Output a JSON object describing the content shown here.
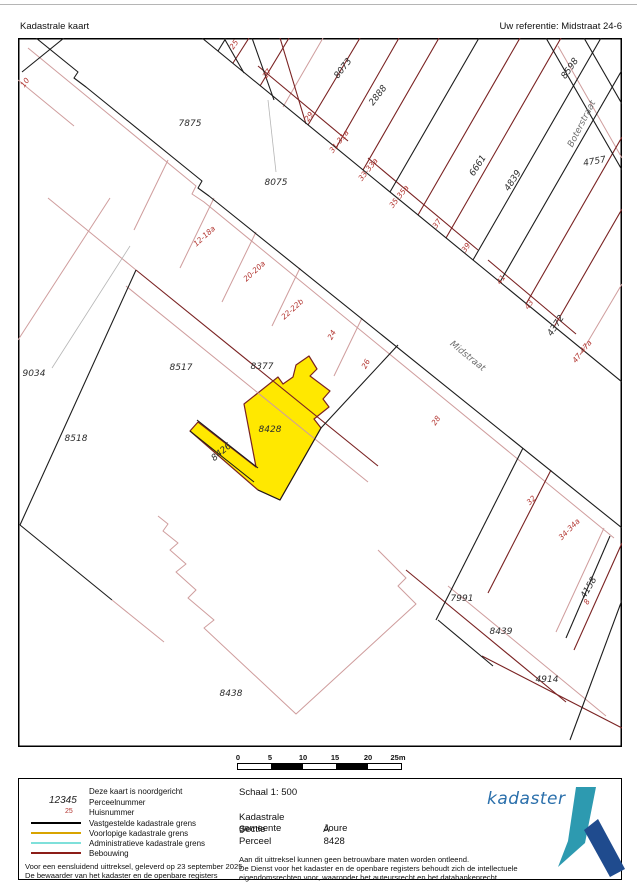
{
  "header": {
    "title": "Kadastrale kaart",
    "reference": "Uw referentie: Midstraat 24-6"
  },
  "map": {
    "highlight_color": "#ffe800",
    "parcel_line_color": "#1c1c1c",
    "building_line_color": "#7a2222",
    "provisional_line_color": "#cf9d9d",
    "parcel_numbers": [
      {
        "text": "7875",
        "x": 172,
        "y": 88,
        "rot": 0
      },
      {
        "text": "8075",
        "x": 258,
        "y": 147,
        "rot": 0
      },
      {
        "text": "8073",
        "x": 327,
        "y": 32,
        "rot": -52
      },
      {
        "text": "2888",
        "x": 362,
        "y": 59,
        "rot": -52
      },
      {
        "text": "6661",
        "x": 462,
        "y": 129,
        "rot": -57
      },
      {
        "text": "4839",
        "x": 497,
        "y": 144,
        "rot": -57
      },
      {
        "text": "4372",
        "x": 540,
        "y": 289,
        "rot": -57
      },
      {
        "text": "8598",
        "x": 554,
        "y": 32,
        "rot": -55
      },
      {
        "text": "4757",
        "x": 577,
        "y": 126,
        "rot": -10
      },
      {
        "text": "9034",
        "x": 16,
        "y": 338,
        "rot": 0
      },
      {
        "text": "8518",
        "x": 58,
        "y": 403,
        "rot": 0
      },
      {
        "text": "8517",
        "x": 163,
        "y": 332,
        "rot": 0
      },
      {
        "text": "8377",
        "x": 244,
        "y": 331,
        "rot": 0
      },
      {
        "text": "8428",
        "x": 252,
        "y": 394,
        "rot": 0
      },
      {
        "text": "8426",
        "x": 205,
        "y": 416,
        "rot": -40
      },
      {
        "text": "7991",
        "x": 444,
        "y": 563,
        "rot": 0
      },
      {
        "text": "8439",
        "x": 483,
        "y": 596,
        "rot": 0
      },
      {
        "text": "4914",
        "x": 529,
        "y": 644,
        "rot": 0
      },
      {
        "text": "4158",
        "x": 573,
        "y": 551,
        "rot": -60
      },
      {
        "text": "8438",
        "x": 213,
        "y": 658,
        "rot": 0
      }
    ],
    "house_numbers": [
      {
        "text": "10",
        "x": 9,
        "y": 46,
        "rot": -55
      },
      {
        "text": "25",
        "x": 218,
        "y": 8,
        "rot": -55
      },
      {
        "text": "27",
        "x": 251,
        "y": 37,
        "rot": -55
      },
      {
        "text": "29",
        "x": 293,
        "y": 80,
        "rot": -55
      },
      {
        "text": "31-31a",
        "x": 323,
        "y": 105,
        "rot": -52
      },
      {
        "text": "33-33a",
        "x": 352,
        "y": 133,
        "rot": -52
      },
      {
        "text": "35-35a",
        "x": 383,
        "y": 160,
        "rot": -52
      },
      {
        "text": "37",
        "x": 421,
        "y": 187,
        "rot": -55
      },
      {
        "text": "39",
        "x": 450,
        "y": 211,
        "rot": -55
      },
      {
        "text": "41",
        "x": 485,
        "y": 243,
        "rot": -55
      },
      {
        "text": "43",
        "x": 513,
        "y": 268,
        "rot": -55
      },
      {
        "text": "47-47a",
        "x": 566,
        "y": 315,
        "rot": -52
      },
      {
        "text": "28",
        "x": 420,
        "y": 384,
        "rot": -55
      },
      {
        "text": "12-18a",
        "x": 188,
        "y": 200,
        "rot": -42
      },
      {
        "text": "20-20a",
        "x": 238,
        "y": 235,
        "rot": -42
      },
      {
        "text": "22-22b",
        "x": 276,
        "y": 273,
        "rot": -42
      },
      {
        "text": "24",
        "x": 316,
        "y": 298,
        "rot": -62
      },
      {
        "text": "26",
        "x": 350,
        "y": 327,
        "rot": -62
      },
      {
        "text": "32",
        "x": 515,
        "y": 464,
        "rot": -45
      },
      {
        "text": "34-34a",
        "x": 553,
        "y": 493,
        "rot": -45
      },
      {
        "text": "8",
        "x": 571,
        "y": 565,
        "rot": -60
      }
    ],
    "street_labels": [
      {
        "text": "Midstraat",
        "x": 448,
        "y": 320,
        "rot": 39
      },
      {
        "text": "Boterstraat",
        "x": 566,
        "y": 87,
        "rot": -63
      }
    ]
  },
  "scalebar": {
    "labels": [
      "0",
      "5",
      "10",
      "15",
      "20",
      "25m"
    ]
  },
  "legend": {
    "north_note": "Deze kaart is noordgericht",
    "parcelnumber_sample": "12345",
    "parcelnumber_label": "Perceelnummer",
    "huisnummer_sample": "25",
    "huisnummer_label": "Huisnummer",
    "items": [
      {
        "label": "Vastgestelde kadastrale grens",
        "color": "#000000"
      },
      {
        "label": "Voorlopige kadastrale grens",
        "color": "#d8a400"
      },
      {
        "label": "Administratieve kadastrale grens",
        "color": "#7fe0da"
      },
      {
        "label": "Bebouwing",
        "color": "#8c1d18"
      }
    ]
  },
  "details": {
    "scale_label": "Schaal 1: 500",
    "rows": [
      {
        "label": "Kadastrale gemeente",
        "value": "Joure"
      },
      {
        "label": "Sectie",
        "value": "A"
      },
      {
        "label": "Perceel",
        "value": "8428"
      }
    ]
  },
  "footnotes": {
    "left1": "Voor een eensluidend uittreksel, geleverd op 23 september 2025",
    "left2": "De bewaarder van het kadaster en de openbare registers",
    "right1": "Aan dit uittreksel kunnen geen betrouwbare maten worden ontleend.",
    "right2": "De Dienst voor het kadaster en de openbare registers behoudt zich de intellectuele",
    "right3": "eigendomsrechten voor, waaronder het auteursrecht en het databankenrecht."
  },
  "logo": {
    "text": "kadaster"
  }
}
